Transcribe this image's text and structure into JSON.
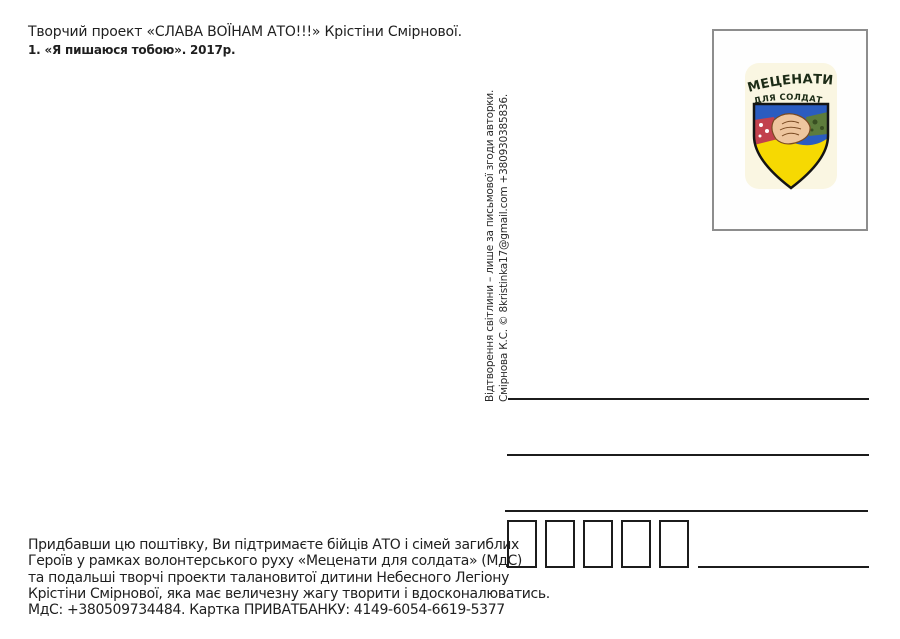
{
  "header": {
    "line1": "Творчий проект «СЛАВА ВОЇНАМ АТО!!!» Крістіни Смірнової.",
    "line2": "1. «Я пишаюся тобою». 2017р."
  },
  "copyright": {
    "line1": "Відтворення світлини – лише за письмової згоди авторки.",
    "line2": "Смірнова К.С. © 8kristinka17@gmail.com +380930385836."
  },
  "stamp": {
    "emblem": {
      "title": "МЕЦЕНАТИ",
      "subtitle": "ДЛЯ СОЛДАТА",
      "colors": {
        "background": "#faf6e2",
        "blue": "#2b5cc0",
        "yellow": "#f6d902",
        "text": "#1c2b16",
        "outline": "#141414",
        "skin": "#eec59e",
        "skin_line": "#7a4a22",
        "sleeve_red": "#c2414d",
        "sleeve_green": "#5d7c3c",
        "camo_dark": "#394f22"
      }
    }
  },
  "address": {
    "postal_code_box_count": 5,
    "line_color": "#1c1c1c"
  },
  "footer": {
    "lines": [
      "Придбавши цю поштівку, Ви підтримаєте бійців АТО і сімей загиблих",
      "Героїв у рамках волонтерського руху «Меценати для солдата» (МдС)",
      "та подальші творчі проекти талановитої дитини Небесного Легіону",
      "Крістіни Смірнової, яка має величезну жагу творити і вдосконалюватись.",
      "МдС: +380509734484. Картка ПРИВАТБАНКУ: 4149-6054-6619-5377"
    ]
  }
}
